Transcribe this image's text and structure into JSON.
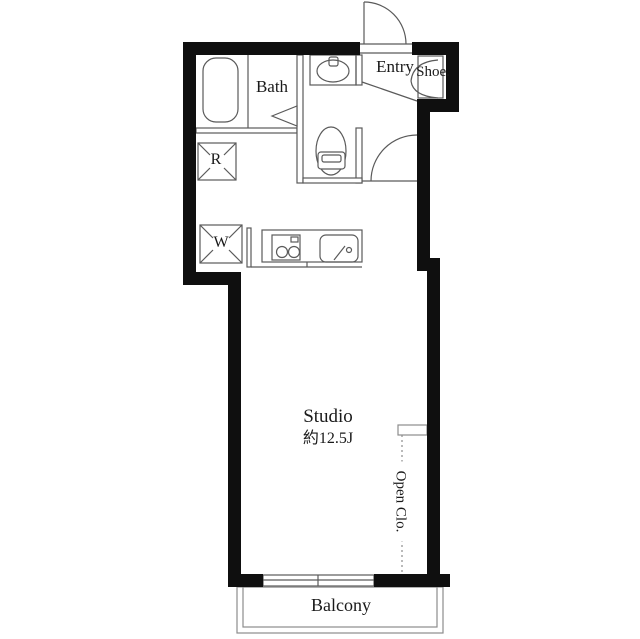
{
  "labels": {
    "bath": "Bath",
    "entry": "Entry",
    "shoe": "Shoe.",
    "refrigerator": "R",
    "washer": "W",
    "studio": "Studio",
    "studio_size": "約12.5J",
    "open_closet": "Open Clo.",
    "balcony": "Balcony"
  },
  "colors": {
    "wall": "#0f0f0f",
    "line": "#5a5a5a",
    "light_line": "#8c8c8c",
    "text": "#1a1a1a",
    "background": "#ffffff"
  }
}
